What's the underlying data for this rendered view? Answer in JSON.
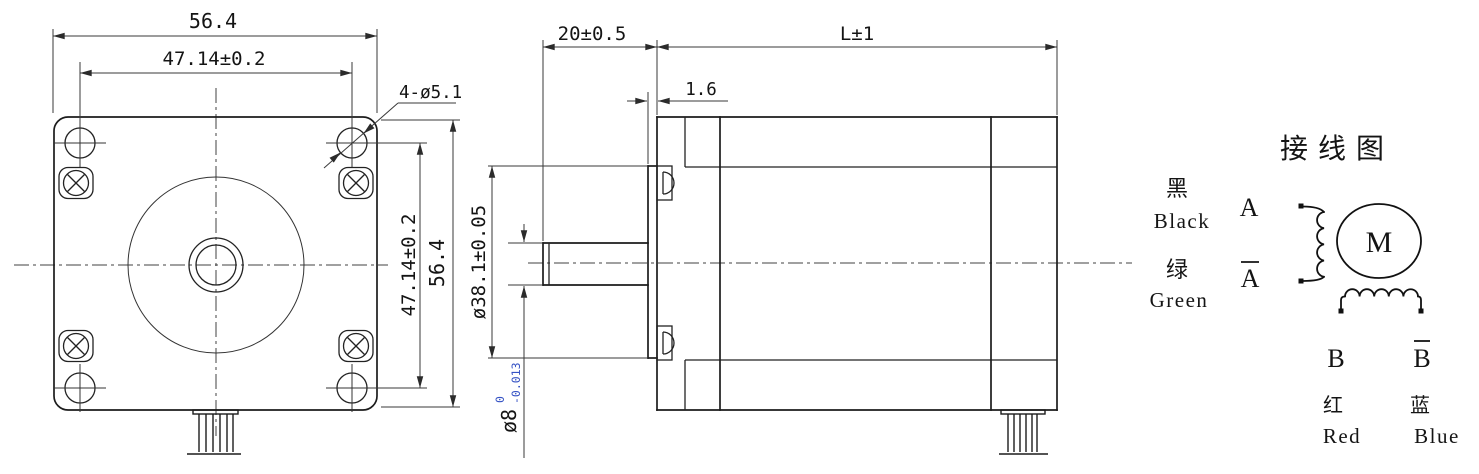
{
  "front_view": {
    "dim_top_outer": "56.4",
    "dim_top_holes": "47.14±0.2",
    "holes_callout": "4-ø5.1",
    "dim_right_holes": "47.14±0.2",
    "dim_right_outer": "56.4"
  },
  "side_view": {
    "dim_shaft_length": "20±0.5",
    "dim_body_length": "L±1",
    "dim_pilot_thickness": "1.6",
    "dim_pilot_dia": "ø38.1±0.05",
    "dim_shaft_dia": "ø8",
    "shaft_tol_upper": "0",
    "shaft_tol_lower": "-0.013"
  },
  "wiring": {
    "title": "接线图",
    "motor": "M",
    "term_a": "A",
    "term_a_bar": "A",
    "term_b": "B",
    "term_b_bar": "B",
    "black_cn": "黑",
    "black_en": "Black",
    "green_cn": "绿",
    "green_en": "Green",
    "red_cn": "红",
    "red_en": "Red",
    "blue_cn": "蓝",
    "blue_en": "Blue"
  },
  "colors": {
    "line": "#1c1c1c",
    "dimension": "#3a3a3a",
    "tolerance_blue": "#3552c4",
    "background": "#ffffff"
  }
}
